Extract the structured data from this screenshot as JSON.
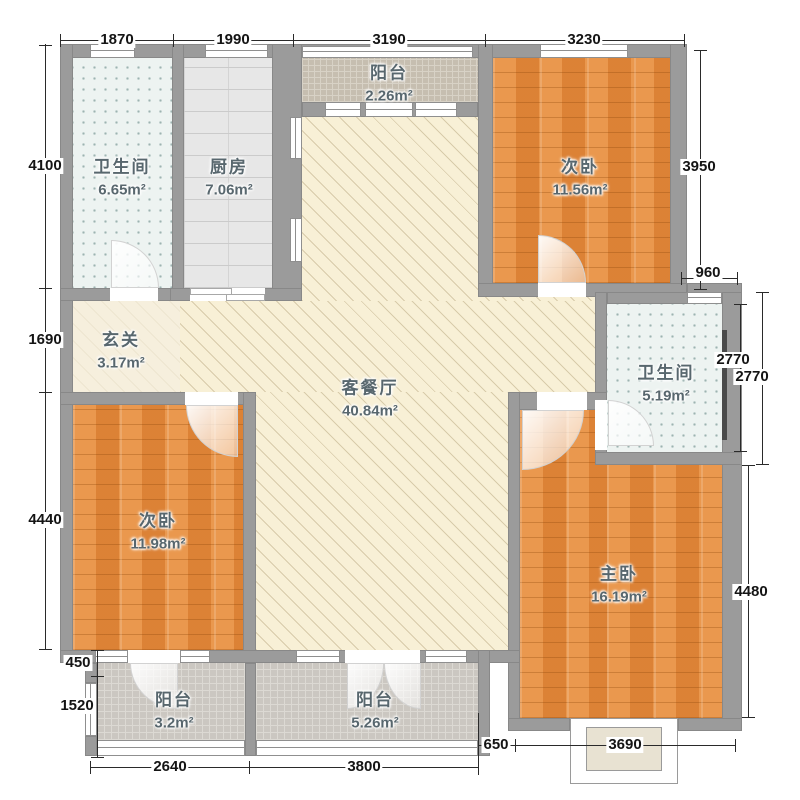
{
  "rooms": {
    "bath_top": {
      "name": "卫生间",
      "area": "6.65m²"
    },
    "kitchen": {
      "name": "厨房",
      "area": "7.06m²"
    },
    "balcony_top": {
      "name": "阳台",
      "area": "2.26m²"
    },
    "bedroom_top_right": {
      "name": "次卧",
      "area": "11.56m²"
    },
    "foyer": {
      "name": "玄关",
      "area": "3.17m²"
    },
    "living_dining": {
      "name": "客餐厅",
      "area": "40.84m²"
    },
    "bath_right": {
      "name": "卫生间",
      "area": "5.19m²"
    },
    "bedroom_bottom_left": {
      "name": "次卧",
      "area": "11.98m²"
    },
    "master_bedroom": {
      "name": "主卧",
      "area": "16.19m²"
    },
    "balcony_bottom_left": {
      "name": "阳台",
      "area": "3.2m²"
    },
    "balcony_bottom_center": {
      "name": "阳台",
      "area": "5.26m²"
    }
  },
  "dimensions": {
    "top": [
      "1870",
      "1990",
      "3190",
      "3230"
    ],
    "left": [
      "4100",
      "1690",
      "4440"
    ],
    "left_inner": [
      "450",
      "1520"
    ],
    "right": [
      "3950",
      "960",
      "2770",
      "2770",
      "4480"
    ],
    "bottom_outer": [
      "2640",
      "3800"
    ],
    "bottom_inner": [
      "650",
      "3690"
    ]
  },
  "colors": {
    "wall": "#9b9b9b",
    "wood_floor": "#e2883a",
    "living_floor": "#f8f0d6",
    "bath_tile": "#edf3f1",
    "kitchen_tile": "#e7e7e7",
    "balcony_tile": "#cbc7c1",
    "dimension_text": "#141414",
    "room_text": "#58676e"
  }
}
